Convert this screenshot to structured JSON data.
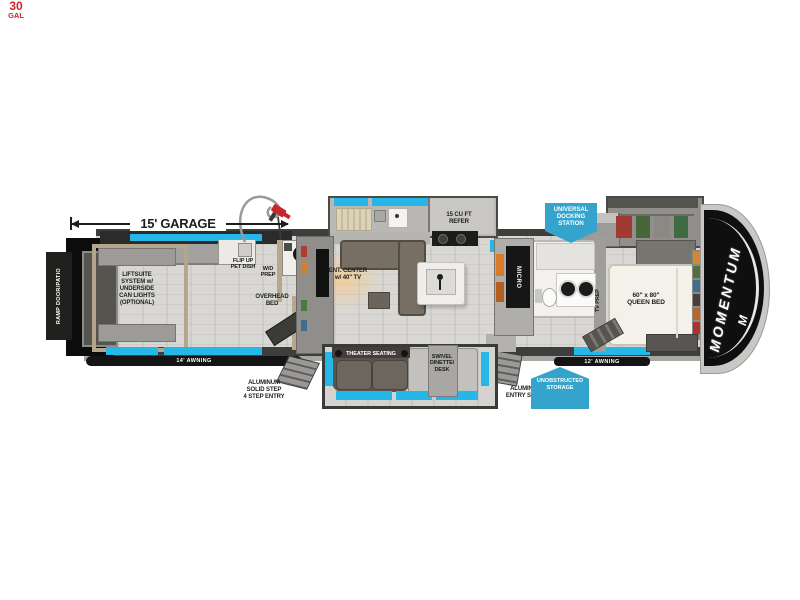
{
  "colors": {
    "window_accent": "#25b7e8",
    "badge_blue": "#35a4cd",
    "fuel_red": "#c9252c",
    "label_dark": "#1d1d1b",
    "cap_black": "#0f0f0f"
  },
  "dimension": {
    "garage_length": "15' GARAGE"
  },
  "fuel_station": {
    "amount": "30",
    "unit": "GAL"
  },
  "rear": {
    "ramp_door": "RAMP DOOR/PATIO"
  },
  "garage": {
    "liftsuite": "LIFTSUITE\nSYSTEM w/\nUNDERSIDE\nCAN LIGHTS\n(OPTIONAL)",
    "pet_dish": "FLIP UP\nPET DISH",
    "wd_prep": "W/D\nPREP",
    "overhead_bed": "OVERHEAD\nBED",
    "awning": "14' AWNING",
    "step_entry": "ALUMINUM\nSOLID STEP\n4 STEP ENTRY"
  },
  "living": {
    "ent_center": "ENT. CENTER\nw/ 40\" TV",
    "refrigerator": "15 CU FT\nREFER",
    "microwave": "MICRO",
    "theater_seating": "THEATER SEATING",
    "dinette": "SWIVEL\nDINETTE/\nDESK",
    "entry_steps": "ALUMINUM\nENTRY STEPS"
  },
  "badges": {
    "docking_station": "UNIVERSAL\nDOCKING\nSTATION",
    "storage": "UNOBSTRUCTED\nSTORAGE"
  },
  "bedroom": {
    "tv_prep": "TV PREP",
    "queen_bed": "60\" x 80\"\nQUEEN BED",
    "awning": "12' AWNING"
  },
  "brand": {
    "name": "MOMENTUM",
    "logo": "M"
  }
}
